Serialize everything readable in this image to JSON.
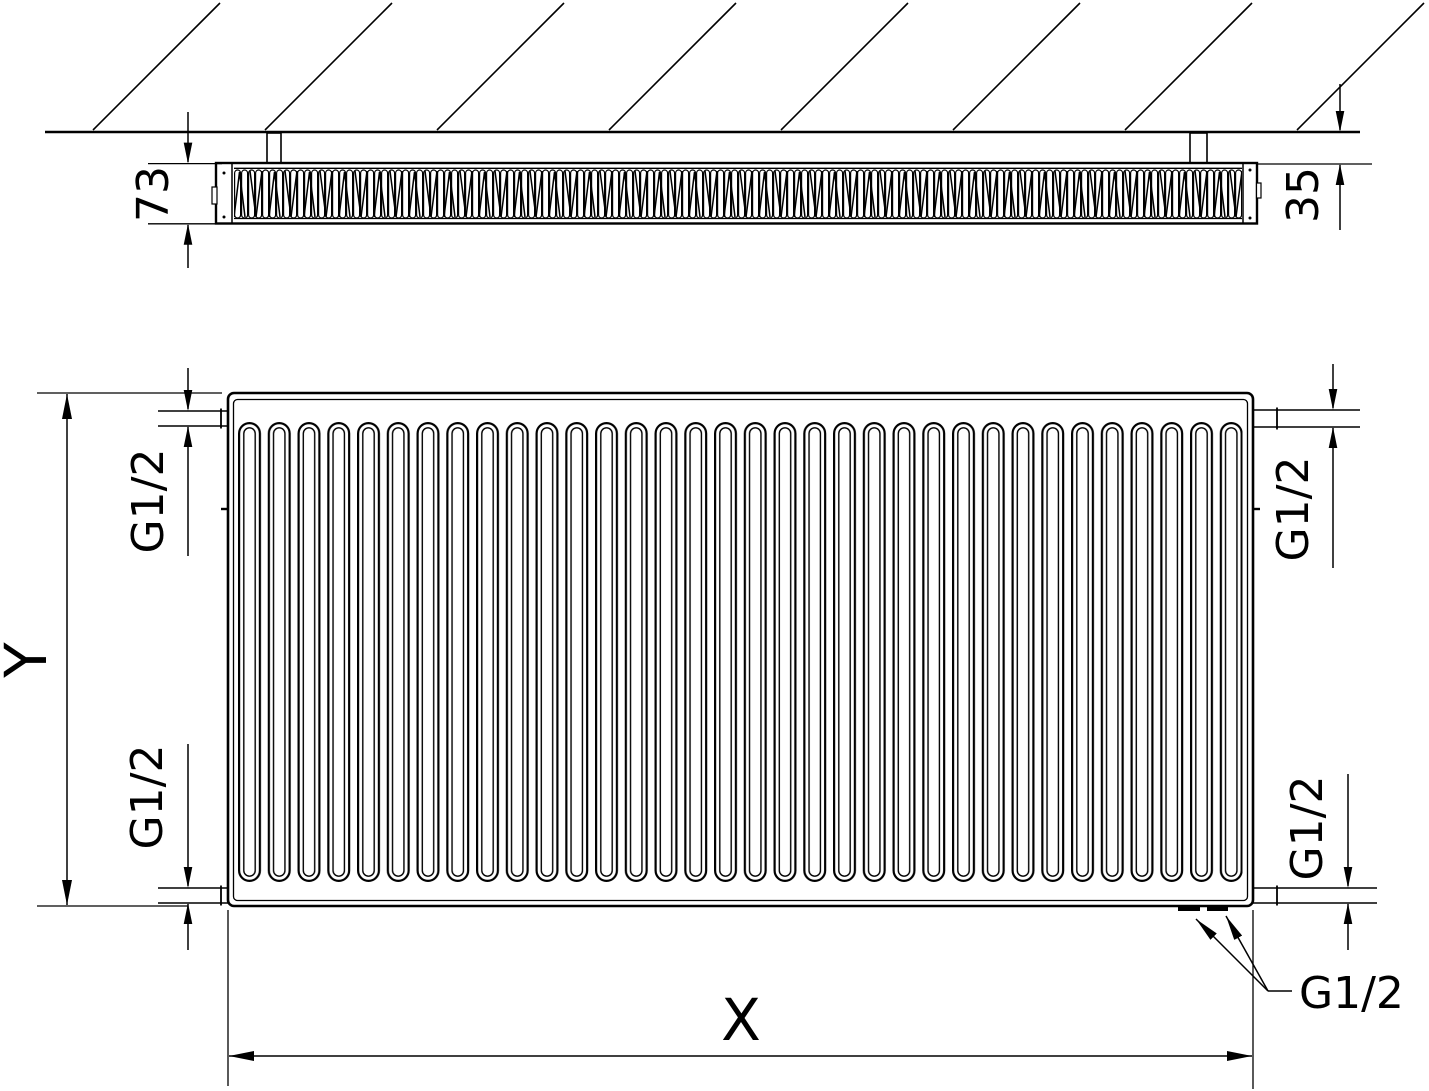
{
  "drawing": {
    "description": "Panel radiator technical dimension drawing, top view and front view",
    "colors": {
      "line": "#000000",
      "background": "#ffffff"
    },
    "top_view": {
      "depth_label": "73",
      "wall_distance_label": "35"
    },
    "front_view": {
      "height_label": "Y",
      "width_label": "X",
      "conn_top_left_label": "G1/2",
      "conn_bottom_left_label": "G1/2",
      "conn_top_right_label": "G1/2",
      "conn_bottom_right_label": "G1/2",
      "conn_bottom_callout_label": "G1/2"
    }
  }
}
